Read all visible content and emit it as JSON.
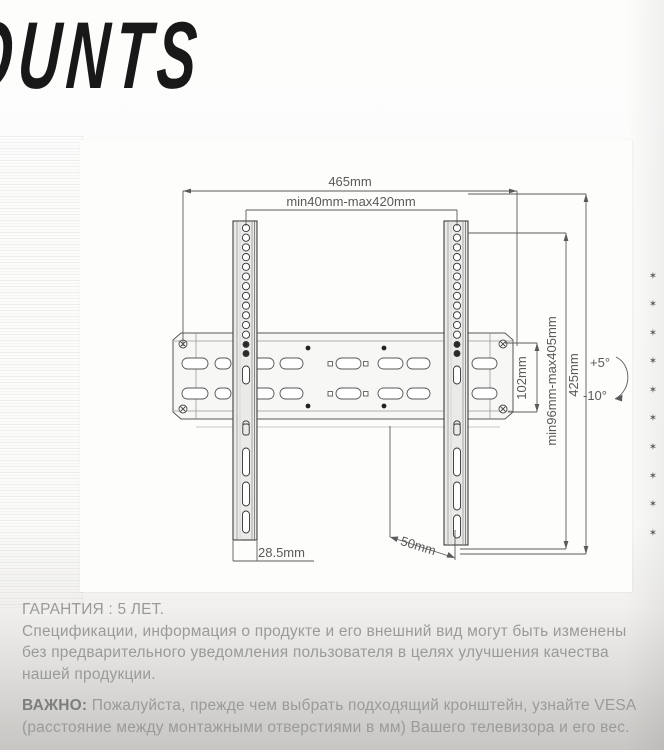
{
  "header": {
    "brand_text": "OUNTS"
  },
  "diagram": {
    "dim_total_width": "465mm",
    "dim_vesa_width_range": "min40mm-max420mm",
    "dim_plate_height": "102mm",
    "dim_vesa_height_range": "min96mm-max405mm",
    "dim_total_height": "425mm",
    "tilt_up": "+5°",
    "tilt_down": "-10°",
    "dim_rail_width": "28.5mm",
    "dim_depth": "50mm",
    "star_char": "✶"
  },
  "footer": {
    "warranty_title": "ГАРАНТИЯ : 5 ЛЕТ.",
    "disclaimer_lines": [
      "Спецификации, информация о продукте и его внешний вид могут быть изменены",
      "без предварительного уведомления пользователя в целях улучшения качества",
      "нашей продукции."
    ],
    "important_label": "ВАЖНО:",
    "important_line1": " Пожалуйста, прежде чем выбрать подходящий кронштейн, узнайте VESA",
    "important_line2": "(расстояние между монтажными отверстиями в мм) Вашего телевизора и его вес."
  },
  "colors": {
    "title_text": "#181818",
    "diagram_line": "#555555",
    "footer_text": "#9a9a9a"
  }
}
